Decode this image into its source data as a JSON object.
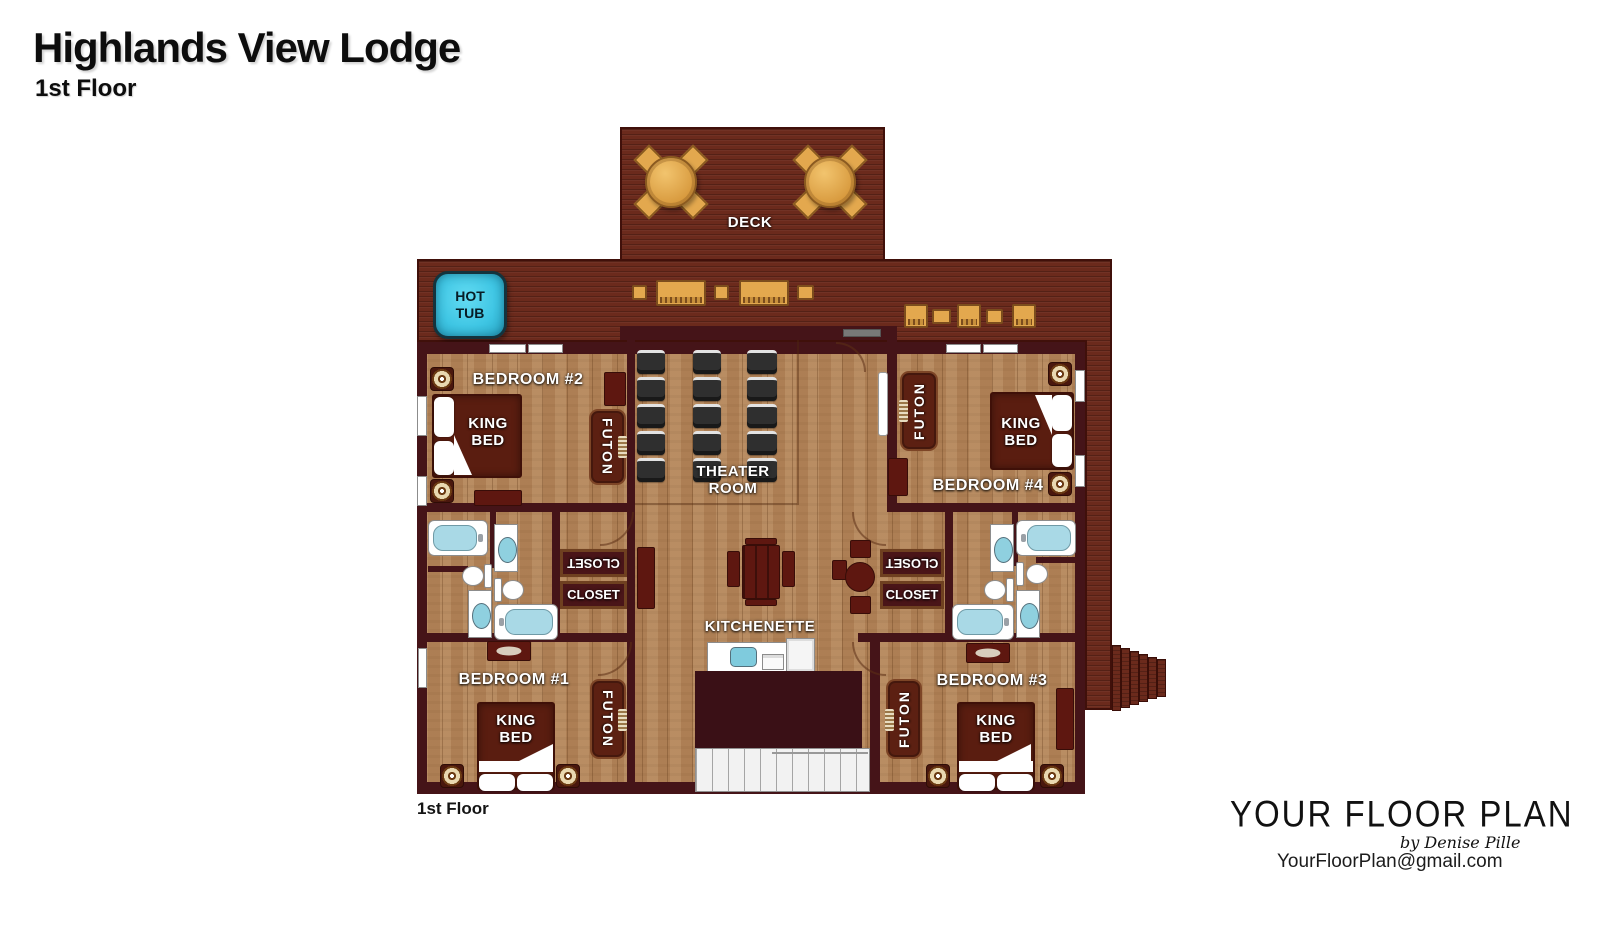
{
  "header": {
    "title": "Highlands View Lodge",
    "subtitle": "1st Floor"
  },
  "plan": {
    "floor_caption": "1st Floor",
    "labels": {
      "deck": "DECK",
      "hot_tub": "HOT\nTUB",
      "theater_room": "THEATER\nROOM",
      "kitchenette": "KITCHENETTE",
      "king_bed": "KING\nBED",
      "futon": "FUTON",
      "closet": "CLOSET",
      "bedroom1": "BEDROOM #1",
      "bedroom2": "BEDROOM #2",
      "bedroom3": "BEDROOM #3",
      "bedroom4": "BEDROOM #4"
    }
  },
  "branding": {
    "logo_text": "YOUR FLOOR PLAN",
    "logo_byline": "by Denise Pille",
    "email": "YourFloorPlan@gmail.com"
  },
  "colors": {
    "deck": "#6b2a1c",
    "wall": "#451418",
    "wood_floor": "#b3855a",
    "hot_tub": "#3fc6e4",
    "furniture_dark_red": "#5e1710",
    "patio_wood": "#e3a84e",
    "theater_seat": "#2f2f2f",
    "bath_fixture_blue": "#a9d9e6"
  }
}
